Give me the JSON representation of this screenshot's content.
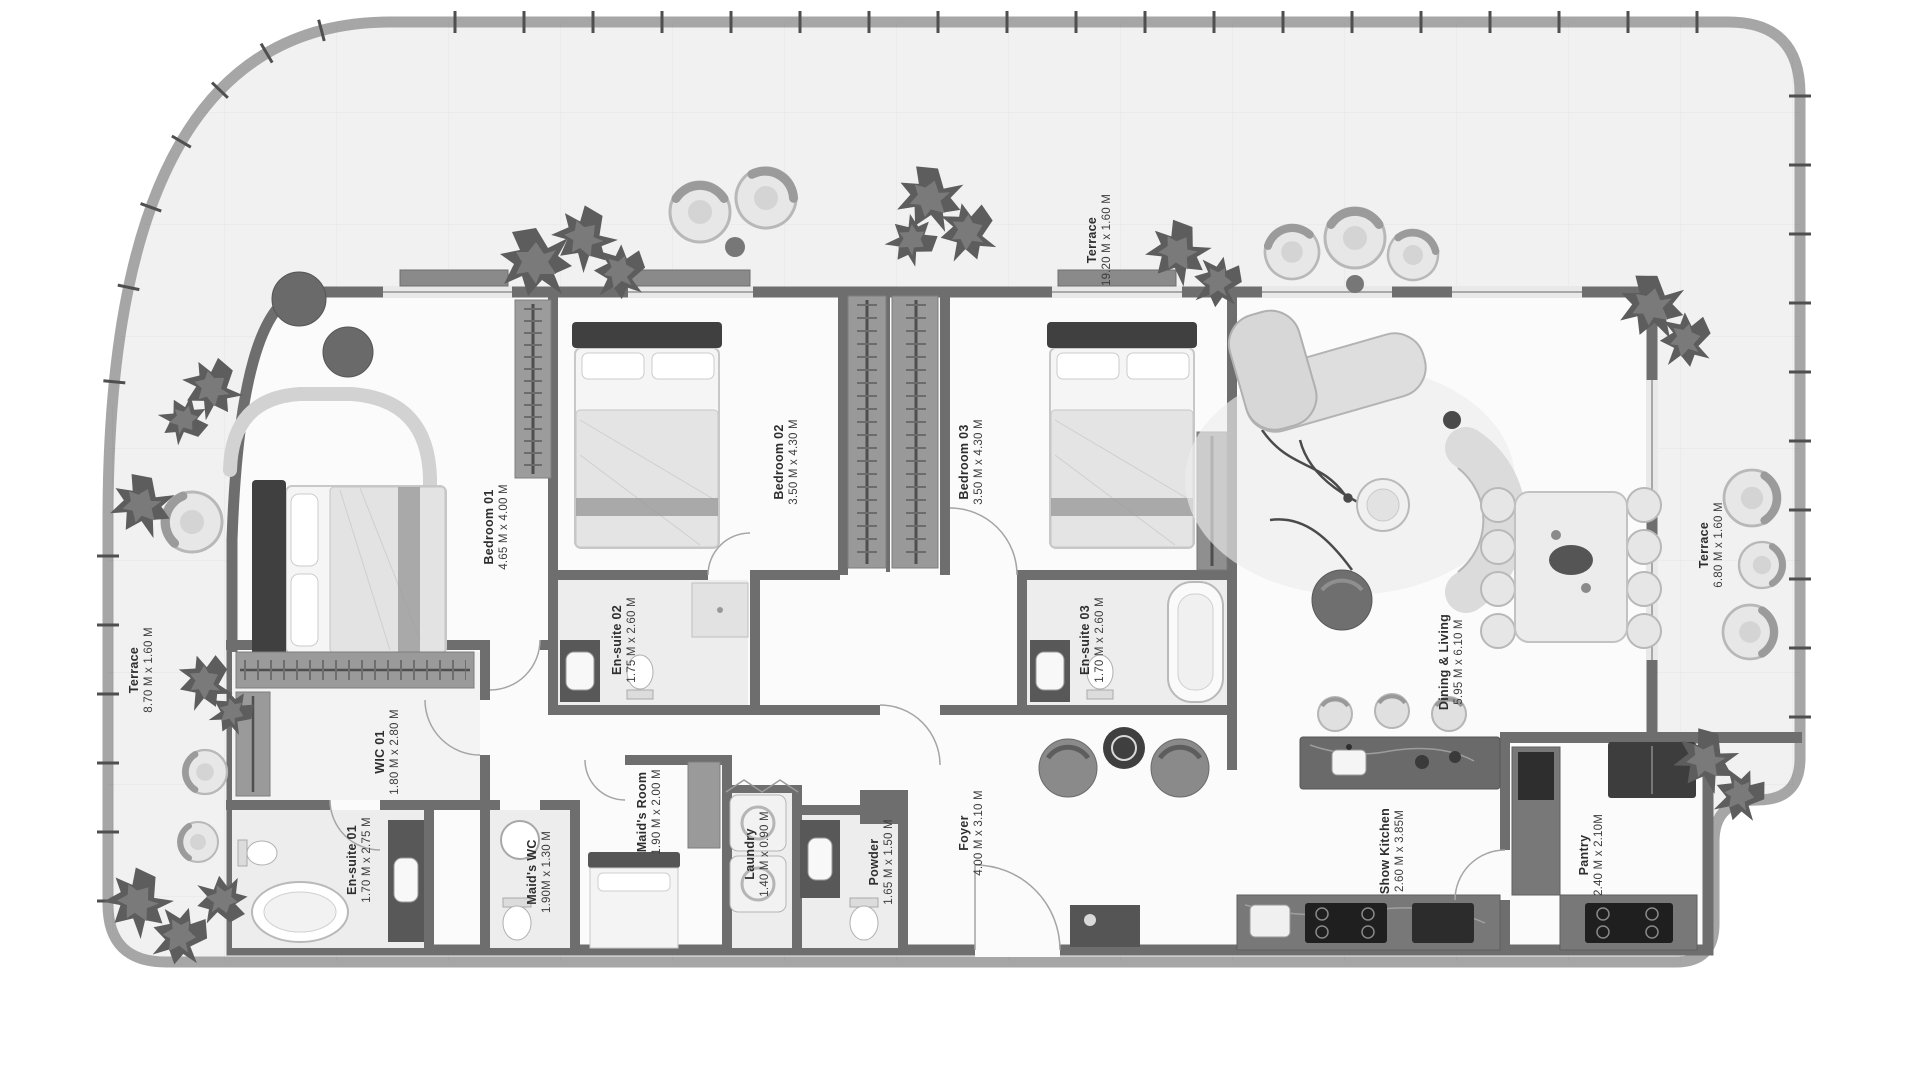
{
  "plan": {
    "rooms": [
      {
        "name": "Bedroom 01",
        "dims": "4.65 M x 4.00 M"
      },
      {
        "name": "Bedroom 02",
        "dims": "3.50 M x 4.30 M"
      },
      {
        "name": "Bedroom 03",
        "dims": "3.50 M x 4.30 M"
      },
      {
        "name": "En-suite 02",
        "dims": "1.75 M x 2.60 M"
      },
      {
        "name": "En-suite 03",
        "dims": "1.70 M x 2.60 M"
      },
      {
        "name": "WIC 01",
        "dims": "1.80 M x 2.80 M"
      },
      {
        "name": "En-suite 01",
        "dims": "1.70 M x 2.75 M"
      },
      {
        "name": "Maid's WC",
        "dims": "1.90M x 1.30 M"
      },
      {
        "name": "Maid's Room",
        "dims": "1.90 M x 2.00 M"
      },
      {
        "name": "Laundry",
        "dims": "1.40 M x 0.90 M"
      },
      {
        "name": "Powder",
        "dims": "1.65 M x 1.50 M"
      },
      {
        "name": "Foyer",
        "dims": "4.00 M x 3.10 M"
      },
      {
        "name": "Dining & Living",
        "dims": "5.95 M x 6.10 M"
      },
      {
        "name": "Show Kitchen",
        "dims": "2.60 M x 3.85M"
      },
      {
        "name": "Pantry",
        "dims": "2.40 M x 2.10M"
      },
      {
        "name": "Terrace",
        "dims": "19.20 M x 1.60 M"
      },
      {
        "name": "Terrace",
        "dims": "6.80 M x 1.60 M"
      },
      {
        "name": "Terrace",
        "dims": "8.70 M x 1.60 M"
      }
    ],
    "colors": {
      "boundary": "#a6a6a6",
      "terrace_floor": "#f1f1f1",
      "wall": "#6e6e6e",
      "interior_floor": "#fbfbfb",
      "bath_floor": "#ededed",
      "dark_furniture": "#4a4a4a",
      "label_text": "#2e2e2e"
    }
  }
}
